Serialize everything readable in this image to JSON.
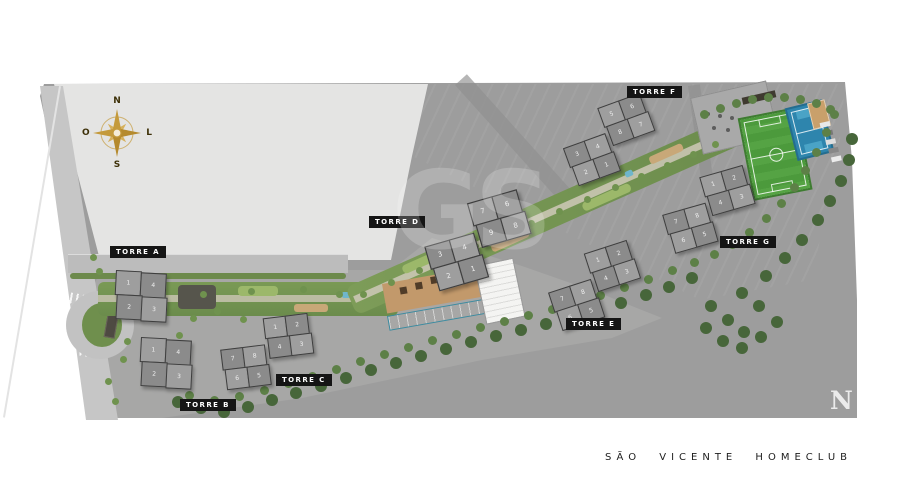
{
  "title": "SÃO VICENTE HOMECLUB",
  "watermark": "GS",
  "corner_logo": "N",
  "compass": {
    "north": "N",
    "south": "S",
    "west": "O",
    "east": "L"
  },
  "towers": [
    {
      "id": "A",
      "label": "TORRE A",
      "units": [
        "1",
        "4",
        "2",
        "3"
      ]
    },
    {
      "id": "B",
      "label": "TORRE B",
      "units": [
        "1",
        "4",
        "2",
        "3"
      ]
    },
    {
      "id": "C",
      "label": "TORRE C",
      "units": [
        "1",
        "2",
        "4",
        "3",
        "7",
        "8",
        "6",
        "5"
      ]
    },
    {
      "id": "D",
      "label": "TORRE D",
      "units": [
        "7",
        "6",
        "9",
        "8",
        "3",
        "4",
        "2",
        "1"
      ]
    },
    {
      "id": "E",
      "label": "TORRE E",
      "units": [
        "1",
        "2",
        "4",
        "3",
        "7",
        "8",
        "6",
        "5"
      ]
    },
    {
      "id": "F",
      "label": "TORRE F",
      "units": [
        "5",
        "6",
        "8",
        "7",
        "3",
        "4",
        "2",
        "1"
      ]
    },
    {
      "id": "G",
      "label": "TORRE G",
      "units": [
        "1",
        "2",
        "4",
        "3",
        "7",
        "8",
        "6",
        "5"
      ]
    }
  ],
  "colors": {
    "field_green": "#4c9a3c",
    "court_blue": "#2e85ad",
    "pool_blue": "#6fb9cd",
    "compass_gold": "#c49a3c",
    "label_bg": "#151515",
    "vacant_lot_gray": "#e4e4e3",
    "pavement_gray": "#9d9d9d"
  }
}
